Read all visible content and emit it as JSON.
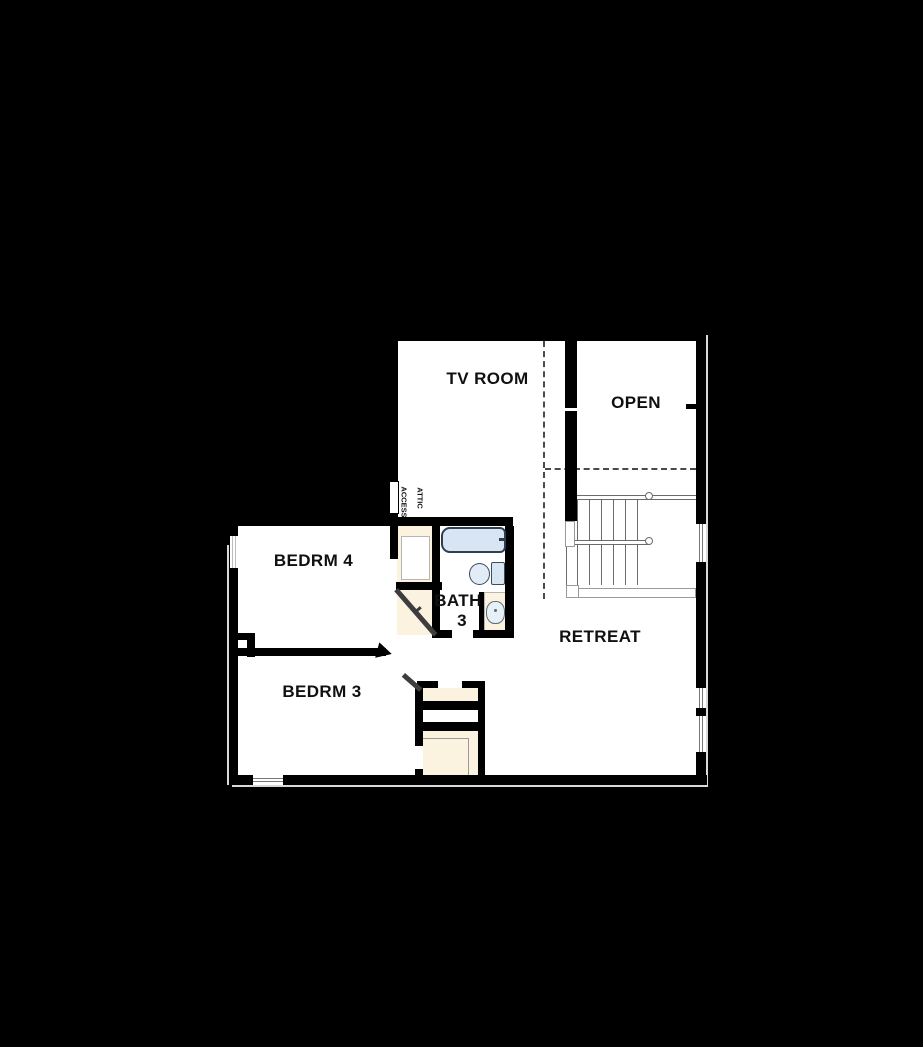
{
  "title": "Second Floor Plan",
  "rooms": {
    "tv_room": "TV ROOM",
    "open": "OPEN",
    "bedrm4": "BEDRM 4",
    "bath_name": "BATH",
    "bath_number": "3",
    "retreat": "RETREAT",
    "bedrm3": "BEDRM 3"
  },
  "annotations": {
    "attic_line1": "ATTIC",
    "attic_line2": "ACCESS"
  },
  "colors": {
    "background": "#000000",
    "wall": "#000000",
    "floor": "#ffffff",
    "closet_tan": "#fbf2e0",
    "fixture_blue": "#d8e6f3",
    "stair_line_gray": "#6b6b6b",
    "dashed_line": "#4a4a4a",
    "label_text": "#101010"
  }
}
